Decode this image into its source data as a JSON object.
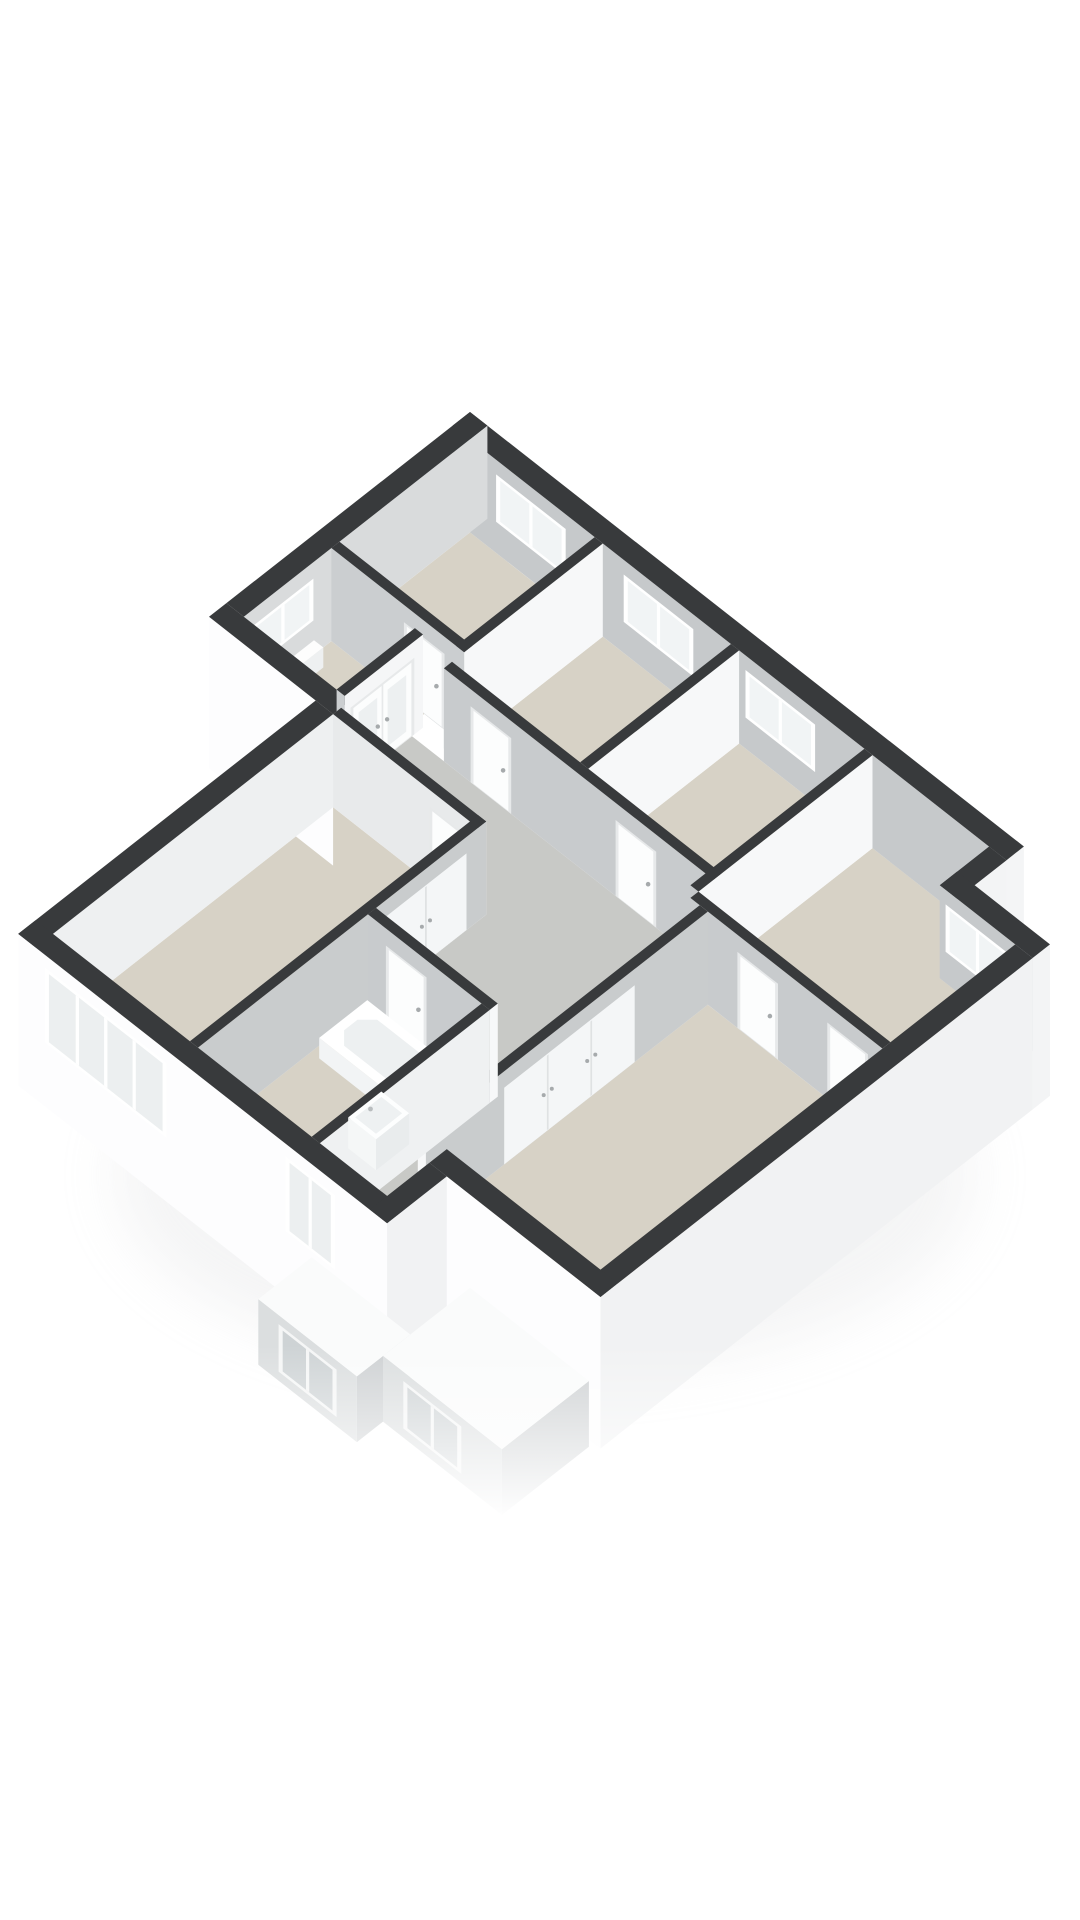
{
  "scene": {
    "type": "isometric-3d-floorplan-render",
    "background": "#ffffff",
    "projection": {
      "originX": 470,
      "originY": 412,
      "ax": 58,
      "ay": 45.5,
      "az": 36.5,
      "wallTop": 2.55
    },
    "palette": {
      "wallTopBand": "#383a3c",
      "exteriorWhite": "#fdfdfe",
      "exteriorLight": "#f1f2f3",
      "innerGray": "#c6c9cb",
      "innerSoft": "#d9dbdc",
      "partitionWhite": "#f7f8f9",
      "floorBeige": "#d7d2c6",
      "floorGray": "#c8c9c6",
      "glassBright": "#f1f4f5",
      "glassFacade": "#eceff0",
      "frameWhite": "#ffffff",
      "doorPanel": "#fcfdfd",
      "doorFrame": "#e7e9ea",
      "handleGray": "#a6aaac",
      "extTop": "#fafbfb",
      "extWallSW": "#dbdedf",
      "extWallSE": "#ced1d3",
      "extGlass": "#ced3d5",
      "shadow": "#ccced0"
    },
    "shadow": {
      "cx": 545,
      "cy": 1175,
      "rx": 430,
      "ry": 200,
      "opacity": 0.2,
      "blur": 28
    },
    "fade": {
      "yStart": 1345,
      "yFull": 1520
    },
    "floors": [
      {
        "name": "bedroom-north",
        "color": "#d7d2c6",
        "poly": [
          [
            0.3,
            0.3
          ],
          [
            2.45,
            0.3
          ],
          [
            2.45,
            2.55
          ],
          [
            0.3,
            2.55
          ]
        ]
      },
      {
        "name": "bedroom-2",
        "color": "#d7d2c6",
        "poly": [
          [
            2.59,
            0.3
          ],
          [
            4.8,
            0.3
          ],
          [
            4.8,
            2.9
          ],
          [
            2.59,
            2.9
          ]
        ]
      },
      {
        "name": "bedroom-3",
        "color": "#d7d2c6",
        "poly": [
          [
            4.94,
            0.3
          ],
          [
            7.1,
            0.3
          ],
          [
            7.1,
            2.9
          ],
          [
            4.94,
            2.9
          ]
        ]
      },
      {
        "name": "bedroom-east",
        "color": "#d7d2c6",
        "poly": [
          [
            7.24,
            0.3
          ],
          [
            9.25,
            0.3
          ],
          [
            9.25,
            1.15
          ],
          [
            10.55,
            1.15
          ],
          [
            10.55,
            3.3
          ],
          [
            7.24,
            3.3
          ]
        ]
      },
      {
        "name": "vestibule",
        "color": "#d8d3c7",
        "poly": [
          [
            0.3,
            2.69
          ],
          [
            1.9,
            2.69
          ],
          [
            1.9,
            4.2
          ],
          [
            0.3,
            4.2
          ]
        ]
      },
      {
        "name": "landing-hall",
        "color": "#c8c9c6",
        "poly": [
          [
            2.04,
            3.04
          ],
          [
            7.4,
            3.04
          ],
          [
            7.4,
            9.33
          ],
          [
            6.74,
            9.33
          ],
          [
            6.74,
            6.26
          ],
          [
            4.64,
            6.26
          ],
          [
            4.64,
            4.36
          ],
          [
            2.04,
            4.36
          ]
        ]
      },
      {
        "name": "master-bedroom",
        "color": "#d7d2c6",
        "poly": [
          [
            2.14,
            4.5
          ],
          [
            4.5,
            4.5
          ],
          [
            4.5,
            9.33
          ],
          [
            2.14,
            9.33
          ]
        ]
      },
      {
        "name": "bathroom",
        "color": "#d7d2c6",
        "poly": [
          [
            4.64,
            6.4
          ],
          [
            6.6,
            6.4
          ],
          [
            6.6,
            9.33
          ],
          [
            4.64,
            9.33
          ]
        ]
      },
      {
        "name": "bedroom-center",
        "color": "#d7d2c6",
        "poly": [
          [
            7.54,
            3.44
          ],
          [
            10.55,
            3.44
          ],
          [
            10.55,
            8.3
          ],
          [
            7.54,
            8.3
          ]
        ]
      }
    ],
    "walls": [
      {
        "name": "facade-ne-upper",
        "layer": 1,
        "x1": 0,
        "y1": 0,
        "x2": 9.55,
        "y2": 0.3,
        "top": "#383a3c",
        "sw": "#c6c9cb",
        "se": "#f4f5f6",
        "op": [
          {
            "kind": "win",
            "face": "SW",
            "a0": 0.75,
            "a1": 1.95,
            "z0": 0.85,
            "z1": 2.15,
            "panes": 2,
            "glass": "#f1f4f5"
          },
          {
            "kind": "win",
            "face": "SW",
            "a0": 2.95,
            "a1": 4.15,
            "z0": 0.85,
            "z1": 2.15,
            "panes": 2,
            "glass": "#f1f4f5"
          },
          {
            "kind": "win",
            "face": "SW",
            "a0": 5.05,
            "a1": 6.25,
            "z0": 0.85,
            "z1": 2.15,
            "panes": 2,
            "glass": "#f1f4f5"
          }
        ]
      },
      {
        "name": "facade-nw-upper",
        "layer": 1,
        "x1": 0,
        "y1": 0,
        "x2": 0.3,
        "y2": 4.2,
        "top": "#383a3c",
        "se": "#d9dbdc",
        "sw": "#fdfdfe",
        "zbSW": -1.6,
        "op": [
          {
            "kind": "win",
            "face": "SE",
            "a0": 3.0,
            "a1": 4.05,
            "z0": 0.95,
            "z1": 2.1,
            "panes": 2,
            "glass": "#f1f4f5"
          }
        ]
      },
      {
        "name": "wall-b1-b2",
        "layer": 1,
        "x1": 2.45,
        "y1": 0.3,
        "x2": 2.59,
        "y2": 2.9,
        "top": "#383a3c",
        "se": "#f7f8f9",
        "sw": "#c6c9cb"
      },
      {
        "name": "wall-b1-south",
        "layer": 1,
        "x1": 0.3,
        "y1": 2.55,
        "x2": 2.59,
        "y2": 2.69,
        "top": "#383a3c",
        "sw": "#cbced0",
        "se": "#f7f8f9",
        "op": [
          {
            "kind": "door",
            "face": "SW",
            "a0": 1.55,
            "a1": 2.25,
            "z0": 0,
            "z1": 2.08
          }
        ]
      },
      {
        "name": "wall-vestibule-doors",
        "layer": 1,
        "x1": 1.9,
        "y1": 2.85,
        "x2": 2.04,
        "y2": 4.2,
        "top": "#383a3c",
        "se": "#f5f6f7",
        "sw": "#cbced0",
        "op": [
          {
            "kind": "ddoor",
            "face": "SE",
            "a0": 3.0,
            "a1": 4.1,
            "z0": 0,
            "z1": 2.1
          }
        ]
      },
      {
        "name": "facade-nw-step",
        "layer": 1,
        "x1": 0,
        "y1": 4.2,
        "x2": 2.14,
        "y2": 4.5,
        "top": "#383a3c",
        "sw": "#fdfdfe",
        "zbSW": -1.6,
        "se": "#f1f3f4"
      },
      {
        "name": "wall-b2-b3",
        "layer": 1,
        "x1": 4.8,
        "y1": 0.3,
        "x2": 4.94,
        "y2": 2.9,
        "top": "#383a3c",
        "se": "#f7f8f9",
        "sw": "#c6c9cb"
      },
      {
        "name": "wall-b3-b4",
        "layer": 1,
        "x1": 7.1,
        "y1": 0.3,
        "x2": 7.24,
        "y2": 3.3,
        "top": "#383a3c",
        "se": "#f7f8f9",
        "sw": "#c6c9cb"
      },
      {
        "name": "wall-landing-north",
        "layer": 1,
        "x1": 2.59,
        "y1": 2.9,
        "x2": 7.24,
        "y2": 3.04,
        "top": "#383a3c",
        "sw": "#c8cbcd",
        "se": "#f7f8f9",
        "op": [
          {
            "kind": "door",
            "face": "SW",
            "a0": 3.05,
            "a1": 3.75,
            "z0": 0,
            "z1": 2.08
          },
          {
            "kind": "door",
            "face": "SW",
            "a0": 5.55,
            "a1": 6.25,
            "z0": 0,
            "z1": 2.08
          }
        ]
      },
      {
        "name": "facade-step-east",
        "layer": 1,
        "x1": 9.25,
        "y1": 0.3,
        "x2": 9.55,
        "y2": 1.15,
        "top": "#383a3c",
        "se": "#f3f4f5",
        "zbSE": -1.6,
        "sw": "#c6c9cb"
      },
      {
        "name": "facade-ne-wing",
        "layer": 1,
        "x1": 9.25,
        "y1": 0.85,
        "x2": 10.85,
        "y2": 1.15,
        "top": "#383a3c",
        "sw": "#c6c9cb",
        "se": "#f3f4f5",
        "zbSE": -1.6,
        "op": [
          {
            "kind": "win",
            "face": "SW",
            "a0": 9.35,
            "a1": 10.45,
            "z0": 0.85,
            "z1": 2.15,
            "panes": 2,
            "glass": "#f1f4f5"
          }
        ]
      },
      {
        "name": "wall-landing-east",
        "layer": 1,
        "x1": 7.24,
        "y1": 3.3,
        "x2": 10.55,
        "y2": 3.44,
        "top": "#383a3c",
        "sw": "#c8cbcd",
        "se": "#f7f8f9",
        "op": [
          {
            "kind": "door",
            "face": "SW",
            "a0": 8.05,
            "a1": 8.75,
            "z0": 0,
            "z1": 2.08
          },
          {
            "kind": "door",
            "face": "SW",
            "a0": 9.6,
            "a1": 10.3,
            "z0": 0,
            "z1": 2.08
          }
        ]
      },
      {
        "name": "wall-corridor-center",
        "layer": 1,
        "x1": 7.4,
        "y1": 3.44,
        "x2": 7.54,
        "y2": 8.3,
        "top": "#383a3c",
        "se": "#c9cccd",
        "sw": "#f7f8f9",
        "op": [
          {
            "kind": "closet",
            "face": "SE",
            "a0": 4.7,
            "a1": 6.95,
            "z0": 0,
            "z1": 2.1,
            "panels": 3
          }
        ]
      },
      {
        "name": "wall-master-north",
        "layer": 1,
        "x1": 2.14,
        "y1": 4.36,
        "x2": 4.64,
        "y2": 4.5,
        "top": "#383a3c",
        "sw": "#e8eaeb",
        "se": "#f7f8f9",
        "op": [
          {
            "kind": "door",
            "face": "SW",
            "a0": 3.8,
            "a1": 4.5,
            "z0": 0,
            "z1": 2.08
          }
        ]
      },
      {
        "name": "wall-master-bath",
        "layer": 1,
        "x1": 4.5,
        "y1": 4.36,
        "x2": 4.64,
        "y2": 9.33,
        "top": "#383a3c",
        "se": "#c9cccd",
        "sw": "#f7f8f9",
        "op": [
          {
            "kind": "closet",
            "face": "SE",
            "a0": 4.7,
            "a1": 6.1,
            "z0": 0,
            "z1": 2.1,
            "panels": 2
          }
        ]
      },
      {
        "name": "facade-nw-lower",
        "layer": 1,
        "x1": 1.84,
        "y1": 4.5,
        "x2": 2.14,
        "y2": 9.63,
        "top": "#383a3c",
        "se": "#eef0f1",
        "sw": "#fdfdfe",
        "zbSW": -1.6
      },
      {
        "name": "wall-bath-north",
        "layer": 1,
        "x1": 4.64,
        "y1": 6.26,
        "x2": 6.74,
        "y2": 6.4,
        "top": "#383a3c",
        "sw": "#c8cbcd",
        "se": "#f7f8f9",
        "op": [
          {
            "kind": "door",
            "face": "SW",
            "a0": 4.95,
            "a1": 5.65,
            "z0": 0,
            "z1": 2.08
          }
        ]
      },
      {
        "name": "wall-bath-corridor",
        "layer": 1,
        "x1": 6.6,
        "y1": 6.4,
        "x2": 6.74,
        "y2": 9.33,
        "top": "#383a3c",
        "se": "#eff1f2",
        "sw": "#f7f8f9"
      },
      {
        "name": "facade-sw-main",
        "layer": 2,
        "x1": 1.84,
        "y1": 9.33,
        "x2": 8.2,
        "y2": 9.63,
        "top": "#383a3c",
        "sw": "#fdfdfe",
        "zbSW": -1.6,
        "se": "#f1f3f4",
        "zbSE": -1.6,
        "op": [
          {
            "kind": "win",
            "face": "SW",
            "a0": 2.3,
            "a1": 4.4,
            "z0": 0.15,
            "z1": 2.2,
            "panes": 4,
            "glass": "#eceff0"
          },
          {
            "kind": "win",
            "face": "SW",
            "a0": 6.45,
            "a1": 7.3,
            "z0": 0.15,
            "z1": 2.2,
            "panes": 2,
            "glass": "#eceff0"
          }
        ]
      },
      {
        "name": "facade-se",
        "layer": 2,
        "x1": 10.55,
        "y1": 1.15,
        "x2": 10.85,
        "y2": 8.6,
        "top": "#383a3c",
        "se": "#f1f2f3",
        "zbSE": -1.6,
        "sw": "#fdfdfe",
        "zbSW": -1.6
      },
      {
        "name": "facade-sw-wing",
        "layer": 2,
        "x1": 7.9,
        "y1": 8.3,
        "x2": 10.85,
        "y2": 8.6,
        "top": "#383a3c",
        "sw": "#fdfdfe",
        "zbSW": -1.6,
        "se": "#f1f2f3",
        "zbSE": -1.6
      },
      {
        "name": "facade-step-south",
        "layer": 2,
        "x1": 7.9,
        "y1": 8.6,
        "x2": 8.2,
        "y2": 9.63,
        "top": "#383a3c",
        "se": "#f1f2f3",
        "zbSE": -1.6,
        "sw": "#fdfdfe",
        "zbSW": -1.6
      }
    ],
    "fixtures": [
      {
        "name": "radiator",
        "kind": "box",
        "x1": 0.36,
        "y1": 3.05,
        "x2": 0.52,
        "y2": 3.95,
        "zb": 0,
        "zt": 0.55,
        "top": "#fdfdfd",
        "se": "#eef0f1",
        "sw": "#f6f8f8"
      },
      {
        "name": "vestibule-sink",
        "kind": "sink",
        "x1": 1.42,
        "y1": 2.8,
        "x2": 1.8,
        "y2": 3.12,
        "zb": 0,
        "zt": 0.85
      },
      {
        "name": "bathtub",
        "kind": "tub",
        "x1": 4.78,
        "y1": 6.55,
        "x2": 6.45,
        "y2": 7.38,
        "zb": 0,
        "zt": 0.56
      },
      {
        "name": "washbasin",
        "kind": "sink",
        "x1": 6.02,
        "y1": 7.55,
        "x2": 6.5,
        "y2": 8.12,
        "zb": 0,
        "zt": 0.85
      },
      {
        "name": "toilet",
        "kind": "toilet",
        "x1": 5.8,
        "y1": 8.5,
        "x2": 6.35,
        "y2": 9.12,
        "zb": 0,
        "zt": 0.45
      }
    ],
    "extensions": [
      {
        "name": "lower-extension-left",
        "x1": 6.9,
        "y1": 9.63,
        "x2": 8.6,
        "y2": 10.55,
        "zb": -1.8,
        "zt": 0,
        "top": "#fafbfb",
        "sw": "#dbdedf",
        "se": "#ced1d3",
        "op": [
          {
            "kind": "win",
            "face": "SW",
            "a0": 7.25,
            "a1": 8.25,
            "z0": -1.55,
            "z1": -0.25,
            "panes": 2,
            "glass": "#ced3d5",
            "frame": "#f5f6f6"
          }
        ]
      },
      {
        "name": "lower-extension-right",
        "x1": 8.6,
        "y1": 8.6,
        "x2": 10.65,
        "y2": 10.1,
        "zb": -1.8,
        "zt": 0,
        "top": "#fafbfb",
        "sw": "#dbdedf",
        "se": "#ced1d3",
        "op": [
          {
            "kind": "win",
            "face": "SW",
            "a0": 8.95,
            "a1": 9.95,
            "z0": -1.55,
            "z1": -0.25,
            "panes": 2,
            "glass": "#ced3d5",
            "frame": "#f5f6f6"
          }
        ]
      }
    ]
  }
}
